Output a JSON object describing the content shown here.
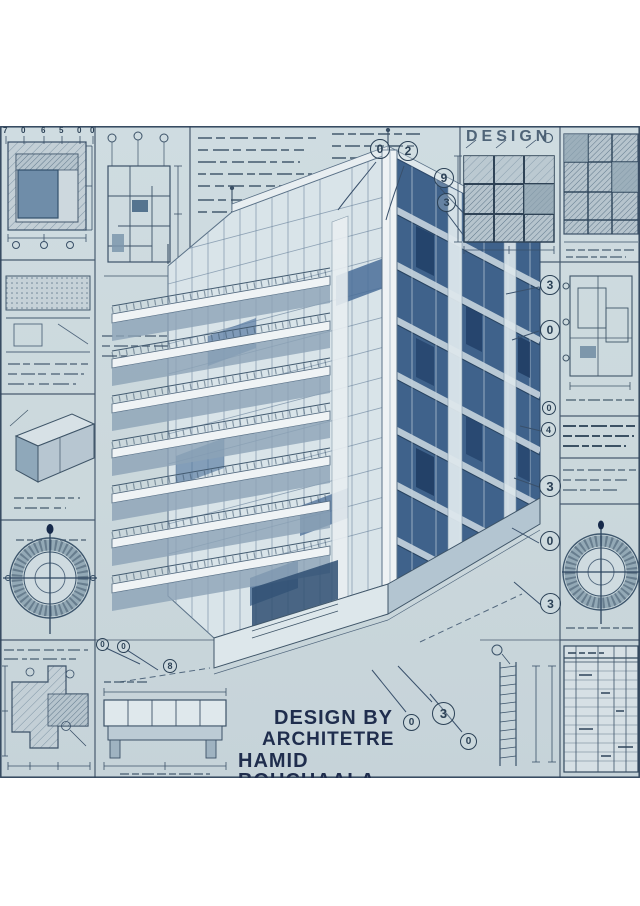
{
  "poster": {
    "background": "#cbd8dc",
    "ink": "#32495e",
    "palette": {
      "paper_white": "#eef2f4",
      "glass_mid": "#5e82a8",
      "glass_deep": "#2f4f76",
      "concrete_shade": "#b3c5d1",
      "text_navy": "#1f2d4d"
    },
    "header": {
      "design_label": "DESIGN"
    },
    "credit": {
      "line1": "DESIGN BY",
      "line2": "ARCHITETRE",
      "line3": "HAMID BOUCHAALA",
      "color": "#1f2d4d"
    },
    "axis_labels": [
      "7",
      "0",
      "6",
      "5",
      "0",
      "0"
    ],
    "callouts": {
      "top": [
        "0",
        "2",
        "9",
        "3"
      ],
      "right": [
        "3",
        "0",
        "0",
        "4",
        "3",
        "0",
        "3"
      ],
      "base": [
        "0",
        "0",
        "8"
      ],
      "bottom": [
        "0",
        "3",
        "0"
      ]
    }
  }
}
